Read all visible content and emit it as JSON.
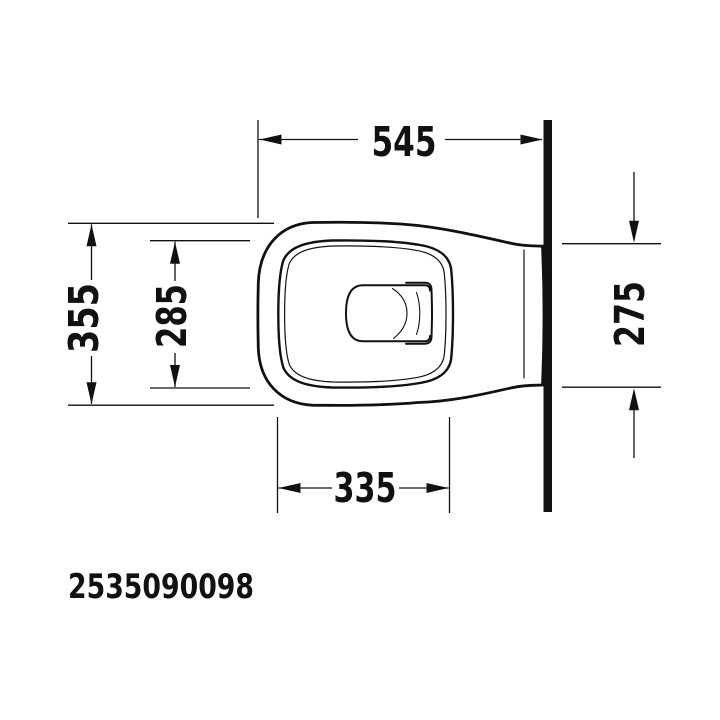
{
  "page": {
    "background_color": "#ffffff",
    "line_color": "#111111"
  },
  "drawing": {
    "product_code": "2535090098",
    "dimensions_mm": {
      "front_to_wall_length": "545",
      "overall_width": "355",
      "inner_rim_width": "285",
      "rim_length": "335",
      "width_at_wall": "275"
    }
  }
}
